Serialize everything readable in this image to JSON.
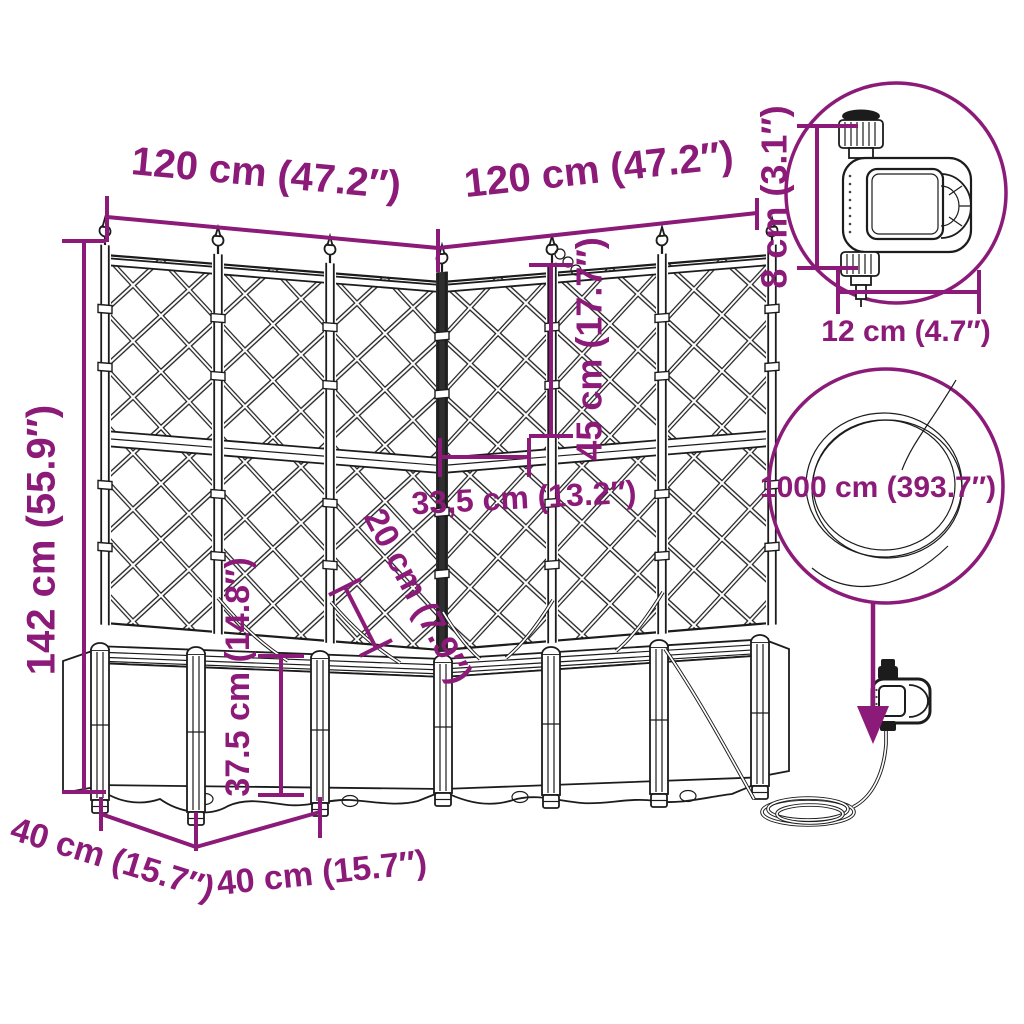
{
  "title": "Corner planter with trellis and irrigation set — dimension diagram",
  "colors": {
    "accent": "#8b1a78",
    "line_art": "#1c1c1c",
    "background": "#ffffff"
  },
  "dimensions": {
    "total_height": "142 cm (55.9″)",
    "left_width": "120 cm (47.2″)",
    "right_width": "120 cm (47.2″)",
    "trellis_upper_section": "45 cm (17.7″)",
    "panel_width": "33,5 cm (13.2″)",
    "corner_depth": "20 cm (7.9″)",
    "planter_box_height": "37.5 cm (14.8″)",
    "left_depth": "40 cm (15.7″)",
    "right_depth": "40 cm (15.7″)",
    "timer_height": "8 cm (3.1″)",
    "timer_width": "12 cm (4.7″)",
    "hose_length": "1000 cm (393.7″)"
  }
}
